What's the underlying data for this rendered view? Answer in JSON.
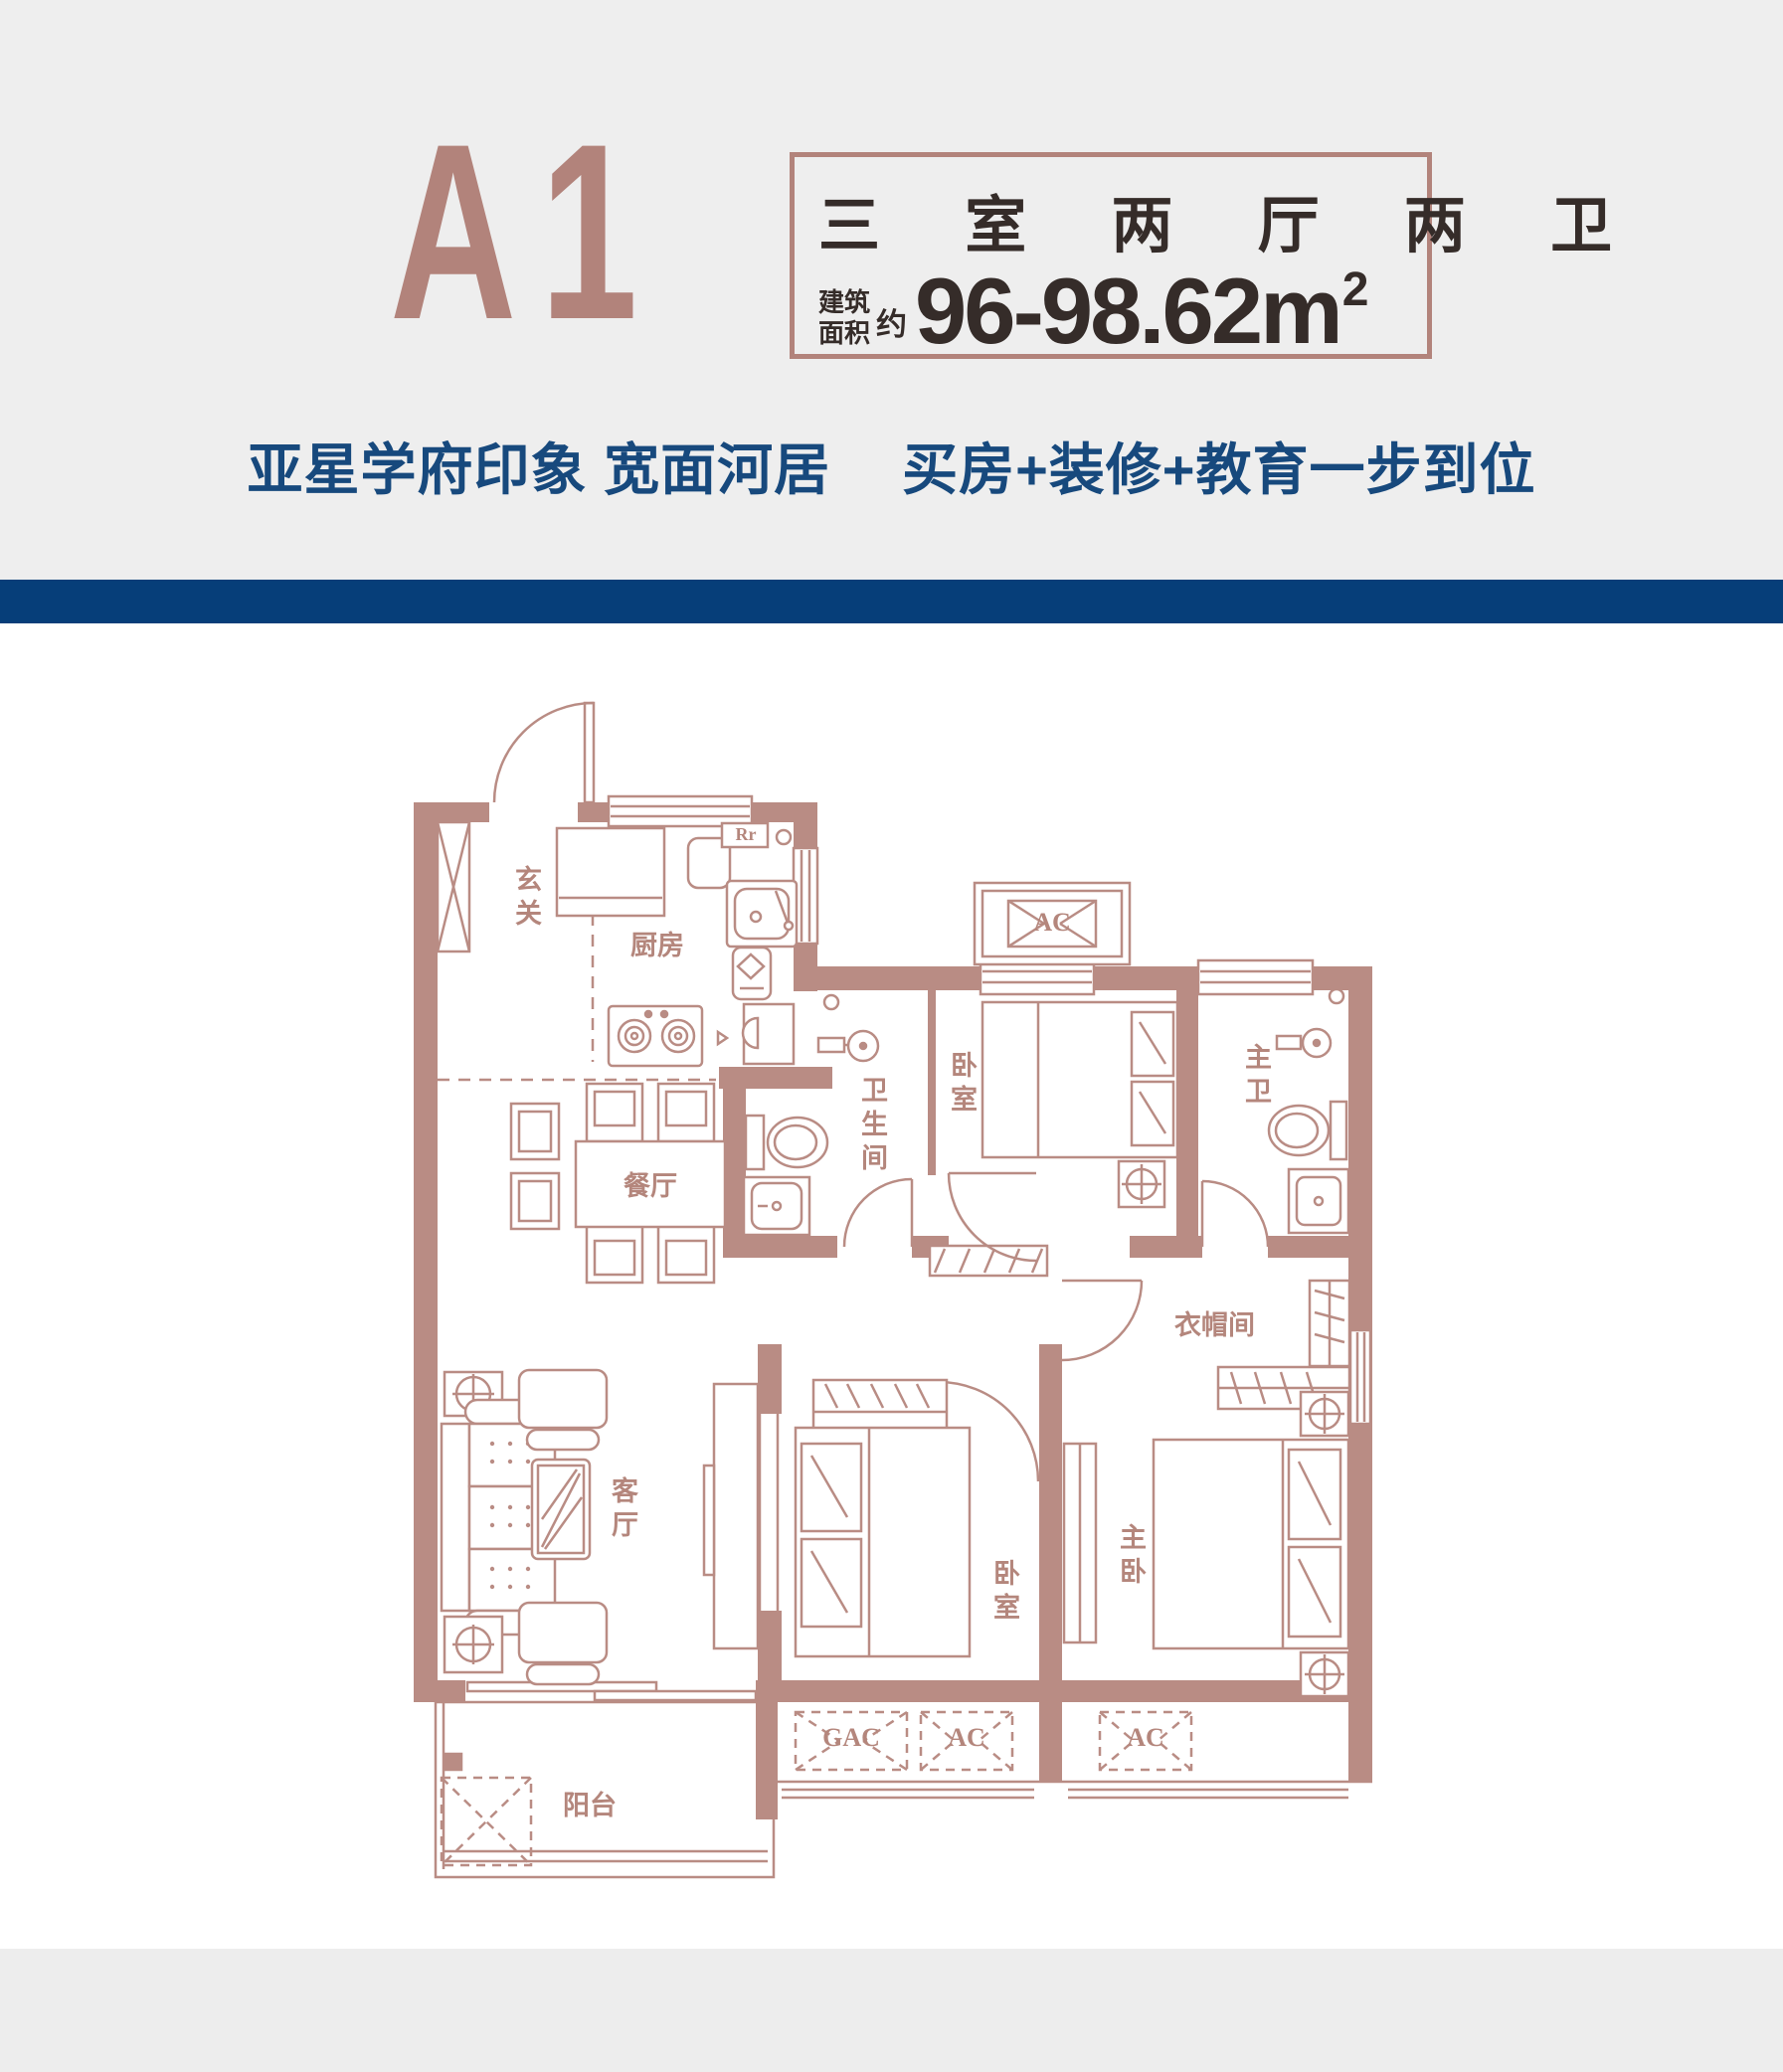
{
  "page": {
    "header_background": "#eeeeee",
    "footer_background": "#ededed",
    "divider_color": "#063e79",
    "accent_rose": "#b2837b",
    "wall_color": "#b98c84",
    "dark_text": "#352c29",
    "navy_text": "#17497d"
  },
  "header": {
    "plan_code": "A1",
    "spec_box": {
      "rooms_line": "三 室 两 厅 两 卫",
      "area_label_top": "建筑",
      "area_label_bottom": "面积",
      "area_prefix": "约",
      "area_value": "96-98.62m",
      "area_superscript": "2"
    },
    "tagline_left": "亚星学府印象 宽面河居",
    "tagline_right": "买房+装修+教育一步到位"
  },
  "floor_plan": {
    "rooms": [
      {
        "id": "foyer",
        "label": "玄关"
      },
      {
        "id": "kitchen",
        "label": "厨房"
      },
      {
        "id": "dining-room",
        "label": "餐厅"
      },
      {
        "id": "bathroom",
        "label": "卫生间"
      },
      {
        "id": "bedroom-north",
        "label": "卧室"
      },
      {
        "id": "master-bathroom",
        "label": "主卫"
      },
      {
        "id": "cloakroom",
        "label": "衣帽间"
      },
      {
        "id": "living-room",
        "label": "客厅"
      },
      {
        "id": "bedroom-south",
        "label": "卧室"
      },
      {
        "id": "master-bedroom",
        "label": "主卧"
      },
      {
        "id": "balcony",
        "label": "阳台"
      }
    ],
    "markers": [
      {
        "id": "fridge",
        "label": "Rr"
      },
      {
        "id": "ac-north",
        "label": "AC"
      },
      {
        "id": "gac-south",
        "label": "GAC"
      },
      {
        "id": "ac-south-center",
        "label": "AC"
      },
      {
        "id": "ac-south-east",
        "label": "AC"
      }
    ]
  }
}
